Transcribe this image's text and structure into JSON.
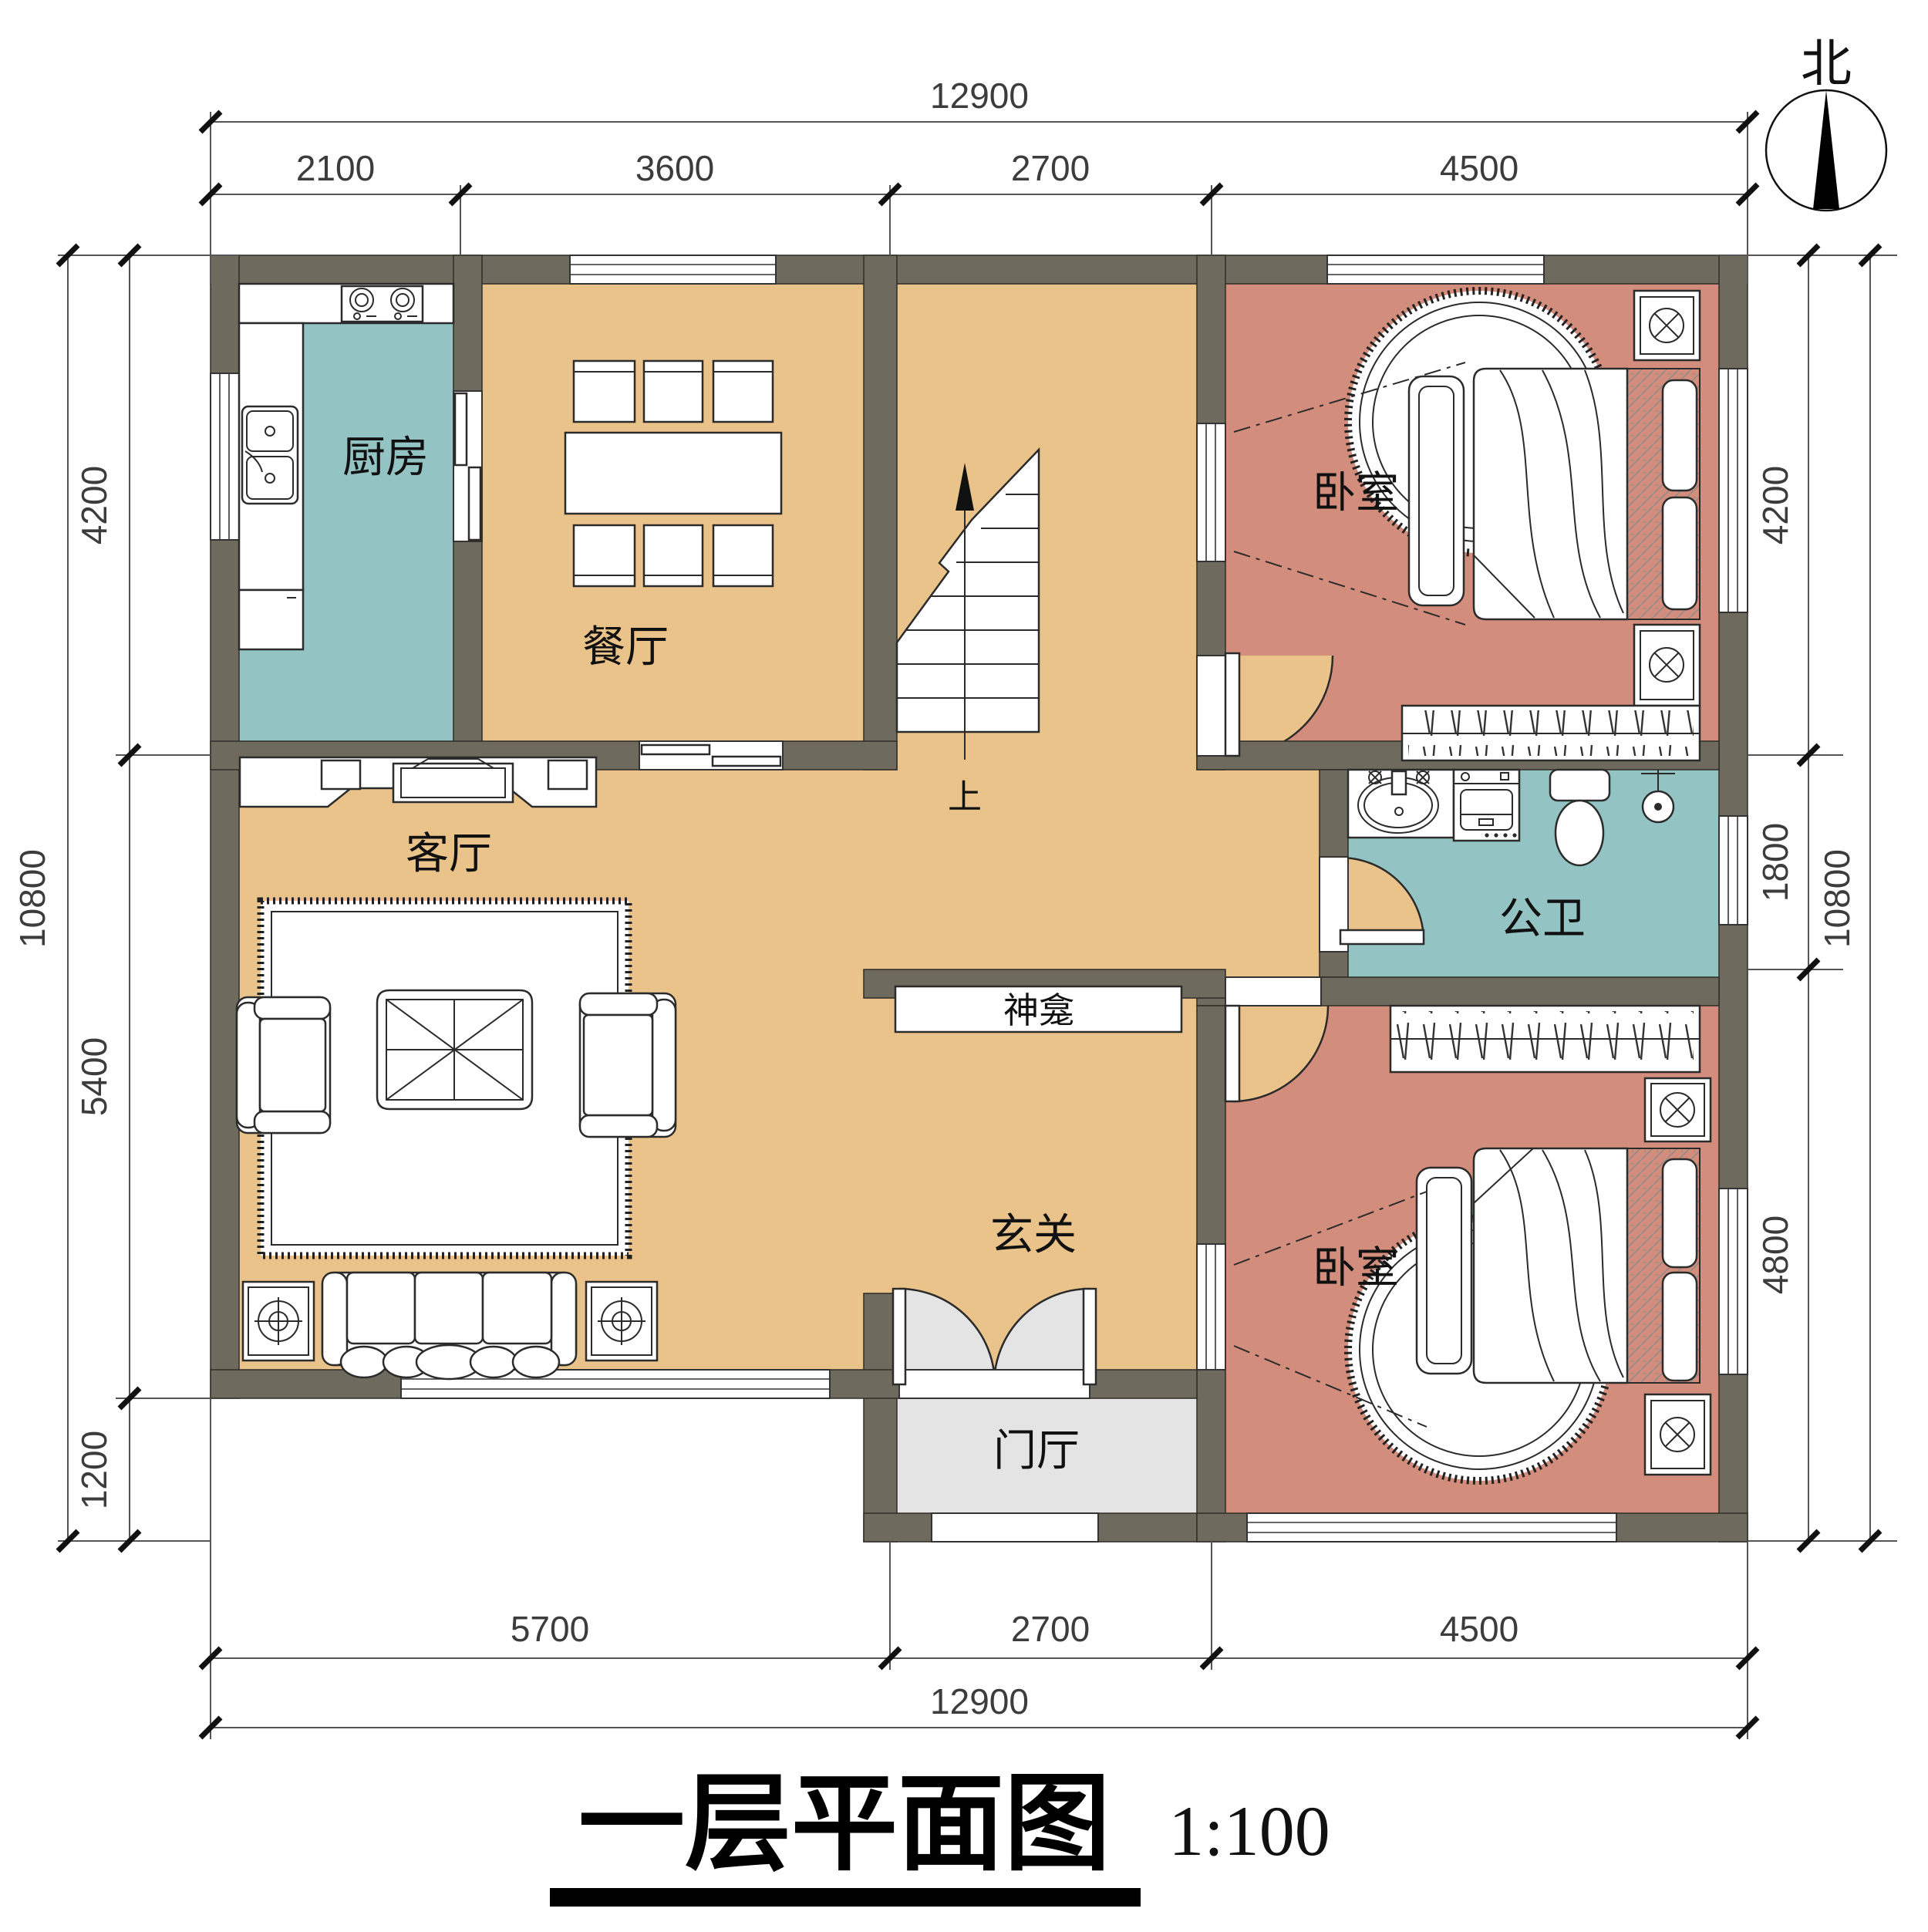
{
  "title": {
    "text": "一层平面图",
    "scale": "1:100"
  },
  "north_label": "北",
  "rooms": {
    "kitchen": "厨房",
    "dining": "餐厅",
    "living": "客厅",
    "bedroom_top": "卧室",
    "bedroom_bottom": "卧室",
    "bathroom": "公卫",
    "shrine": "神龛",
    "entry_hall": "玄关",
    "foyer": "门厅",
    "stairs_up": "上"
  },
  "dimensions": {
    "top_total": "12900",
    "top_segments": [
      "2100",
      "3600",
      "2700",
      "4500"
    ],
    "bottom_segments": [
      "5700",
      "2700",
      "4500"
    ],
    "bottom_total": "12900",
    "left_segments": [
      "4200",
      "5400",
      "1200"
    ],
    "left_total": "10800",
    "right_segments": [
      "4200",
      "1800",
      "4800"
    ],
    "right_total": "10800"
  },
  "colors": {
    "wall": "#6e6b5e",
    "floor_main": "#e9c38a",
    "floor_bedroom": "#d28d7c",
    "floor_wet": "#93c4c3",
    "floor_foyer": "#e4e4e4"
  }
}
